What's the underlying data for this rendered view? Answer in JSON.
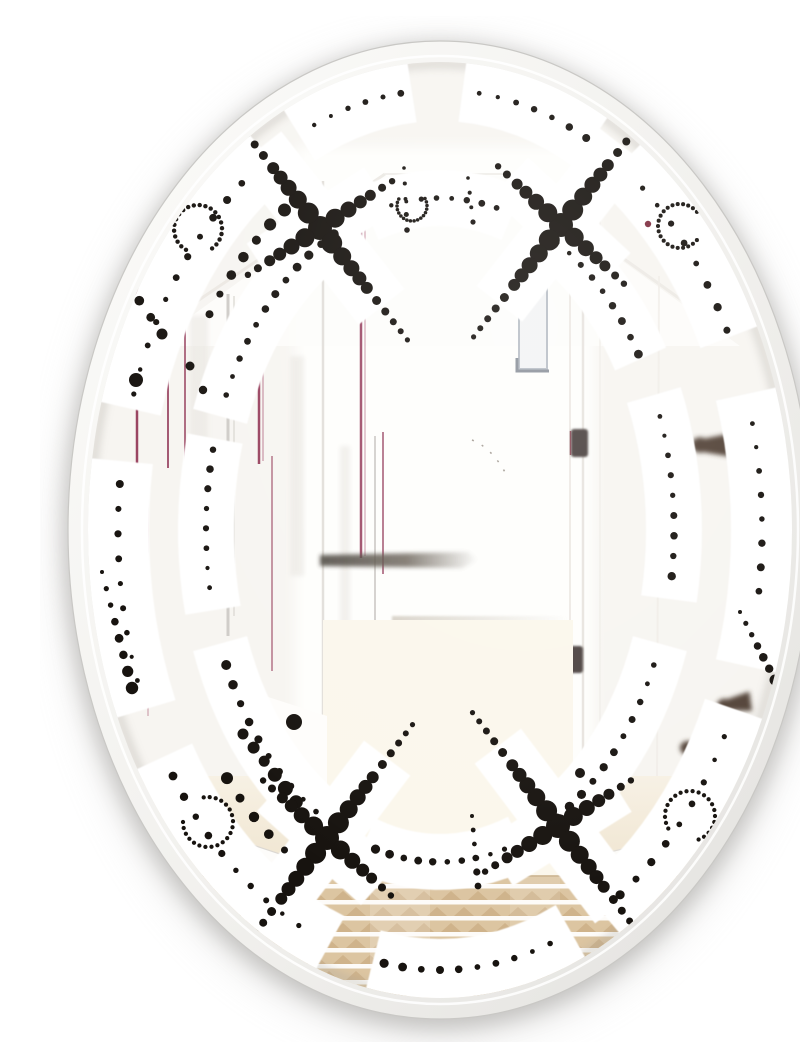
{
  "meta": {
    "subject": "Oval beveled wall mirror with a black dotted retro pattern printed on the glass, reflecting a bright white hallway with picture frames, an open white door and a beige striped rug"
  },
  "colors": {
    "background": "#ffffff",
    "shadow": "#a3a19e",
    "shadow_soft": "#b8b6b3",
    "bevel_light": "#fcfcfa",
    "bevel_dark": "#e2e1de",
    "bevel_edge": "#c9c8c5",
    "glass_base": "#f7f5f1",
    "glass_bright": "#fefefc",
    "band": "#ffffff",
    "dot": "#17130f",
    "maroon": "#8e2f50",
    "maroon_light": "#b0647e",
    "gray_line": "#cfccc8",
    "gray_line_light": "#dedbd6",
    "hinge": "#4b4240",
    "hinge_sliver": "#7e3040",
    "peg": "#453528",
    "bench_shadow": "#4f4840",
    "dim_line": "#d6cfc4",
    "window_frame": "#b9bfc7",
    "window_corner": "#8d939c",
    "wedge": "#6e6861",
    "floor": "#f6efe1",
    "floor_bright": "#fbf7ec",
    "rug_base": "#dcc5a1",
    "rug_stripe": "#ffffff",
    "rug_triangle": "#c9ab81",
    "rug_edge": "#c3a87f"
  },
  "mirror": {
    "cx": 400,
    "cy": 514,
    "rx": 372,
    "ry": 489,
    "glass_rx": 352,
    "glass_ry": 468
  },
  "pattern": {
    "rings": {
      "outer": {
        "rx": 322,
        "ry": 440,
        "band": 62
      },
      "inner": {
        "rx": 234,
        "ry": 332,
        "band": 56
      },
      "mid": {
        "rx": 278,
        "ry": 386,
        "band": 0
      }
    },
    "band_segments": {
      "outer": [
        [
          196,
          240
        ],
        [
          244,
          266
        ],
        [
          274,
          300
        ],
        [
          304,
          336
        ],
        [
          342,
          378
        ],
        [
          24,
          60
        ],
        [
          66,
          104
        ],
        [
          110,
          150
        ],
        [
          156,
          190
        ]
      ],
      "inner": [
        [
          200,
          246
        ],
        [
          252,
          288
        ],
        [
          296,
          330
        ],
        [
          336,
          374
        ],
        [
          20,
          64
        ],
        [
          70,
          110
        ],
        [
          118,
          160
        ],
        [
          166,
          196
        ]
      ]
    },
    "x_motifs": [
      {
        "cx": 280,
        "cy": 212,
        "angle": 52
      },
      {
        "cx": 521,
        "cy": 209,
        "angle": 128
      },
      {
        "cx": 287,
        "cy": 822,
        "angle": 127
      },
      {
        "cx": 518,
        "cy": 810,
        "angle": 53
      }
    ],
    "hooks": [
      {
        "cx": 158,
        "cy": 213,
        "r": 24,
        "a0": 120,
        "a1": 420,
        "dr": 2.6
      },
      {
        "cx": 372,
        "cy": 190,
        "r": 15,
        "a0": -30,
        "a1": 210,
        "dr": 2.1
      },
      {
        "cx": 640,
        "cy": 210,
        "r": 22,
        "a0": 40,
        "a1": 330,
        "dr": 2.4
      },
      {
        "cx": 168,
        "cy": 806,
        "r": 25,
        "a0": -100,
        "a1": 180,
        "dr": 2.5
      },
      {
        "cx": 650,
        "cy": 800,
        "r": 25,
        "a0": 150,
        "a1": 430,
        "dr": 2.5
      }
    ],
    "arc_chains": [
      {
        "ring": "outer",
        "a0": 198,
        "a1": 232,
        "n": 11,
        "r0": 2.6,
        "r1": 4.2
      },
      {
        "ring": "outer",
        "a0": 247,
        "a1": 263,
        "n": 6,
        "r0": 2.2,
        "r1": 3.4
      },
      {
        "ring": "outer",
        "a0": 277,
        "a1": 297,
        "n": 7,
        "r0": 2.4,
        "r1": 4.0
      },
      {
        "ring": "outer",
        "a0": 309,
        "a1": 333,
        "n": 8,
        "r0": 2.6,
        "r1": 4.4
      },
      {
        "ring": "outer",
        "a0": 346,
        "a1": 368,
        "n": 8,
        "r0": 2.4,
        "r1": 4.2
      },
      {
        "ring": "outer",
        "a0": 28,
        "a1": 56,
        "n": 9,
        "r0": 2.6,
        "r1": 4.6
      },
      {
        "ring": "outer",
        "a0": 70,
        "a1": 100,
        "n": 10,
        "r0": 2.8,
        "r1": 4.6
      },
      {
        "ring": "outer",
        "a0": 116,
        "a1": 146,
        "n": 10,
        "r0": 2.6,
        "r1": 4.4
      },
      {
        "ring": "outer",
        "a0": 160,
        "a1": 186,
        "n": 9,
        "r0": 2.4,
        "r1": 4.0
      },
      {
        "ring": "inner",
        "a0": 204,
        "a1": 243,
        "n": 12,
        "r0": 2.8,
        "r1": 5.0
      },
      {
        "ring": "inner",
        "a0": 258,
        "a1": 284,
        "n": 8,
        "r0": 2.2,
        "r1": 3.6
      },
      {
        "ring": "inner",
        "a0": 300,
        "a1": 328,
        "n": 9,
        "r0": 2.6,
        "r1": 4.4
      },
      {
        "ring": "inner",
        "a0": 340,
        "a1": 368,
        "n": 9,
        "r0": 2.4,
        "r1": 4.2
      },
      {
        "ring": "inner",
        "a0": 24,
        "a1": 60,
        "n": 11,
        "r0": 2.8,
        "r1": 5.0
      },
      {
        "ring": "inner",
        "a0": 74,
        "a1": 106,
        "n": 10,
        "r0": 2.6,
        "r1": 4.6
      },
      {
        "ring": "inner",
        "a0": 122,
        "a1": 156,
        "n": 10,
        "r0": 2.8,
        "r1": 5.0
      },
      {
        "ring": "inner",
        "a0": 170,
        "a1": 194,
        "n": 8,
        "r0": 2.4,
        "r1": 4.0
      },
      {
        "ring": "mid",
        "a0": 214,
        "a1": 236,
        "n": 7,
        "r0": 4.0,
        "r1": 6.5
      },
      {
        "ring": "mid",
        "a0": 120,
        "a1": 140,
        "n": 6,
        "r0": 4.0,
        "r1": 6.0
      }
    ],
    "line_chains": [
      {
        "x0": 62,
        "y0": 556,
        "x1": 92,
        "y1": 672,
        "n": 8,
        "r0": 2.0,
        "r1": 6.2
      },
      {
        "x0": 700,
        "y0": 596,
        "x1": 735,
        "y1": 664,
        "n": 7,
        "r0": 2.0,
        "r1": 5.5
      },
      {
        "x0": 652,
        "y0": 156,
        "x1": 706,
        "y1": 232,
        "n": 7,
        "r0": 2.5,
        "r1": 6.0
      },
      {
        "x0": 52,
        "y0": 828,
        "x1": 92,
        "y1": 888,
        "n": 6,
        "r0": 3.0,
        "r1": 5.5
      },
      {
        "x0": 88,
        "y0": 268,
        "x1": 122,
        "y1": 318,
        "n": 4,
        "r0": 4.5,
        "r1": 5.5
      },
      {
        "x0": 364,
        "y0": 152,
        "x1": 367,
        "y1": 214,
        "n": 5,
        "r0": 1.8,
        "r1": 2.8
      },
      {
        "x0": 428,
        "y0": 162,
        "x1": 433,
        "y1": 206,
        "n": 4,
        "r0": 1.8,
        "r1": 2.6
      },
      {
        "x0": 432,
        "y0": 800,
        "x1": 438,
        "y1": 870,
        "n": 6,
        "r0": 2.0,
        "r1": 4.0
      },
      {
        "x0": 203,
        "y0": 718,
        "x1": 256,
        "y1": 786,
        "n": 6,
        "r0": 5.5,
        "r1": 8.0
      }
    ],
    "accent_dots": [
      {
        "x": 608,
        "y": 208,
        "r": 3.2,
        "c": "#7e2d3f"
      },
      {
        "x": 96,
        "y": 364,
        "r": 7,
        "c": ""
      },
      {
        "x": 254,
        "y": 706,
        "r": 8,
        "c": ""
      },
      {
        "x": 540,
        "y": 757,
        "r": 5,
        "c": ""
      },
      {
        "x": 150,
        "y": 350,
        "r": 4.5,
        "c": ""
      },
      {
        "x": 163,
        "y": 374,
        "r": 4.2,
        "c": ""
      }
    ]
  },
  "reflection": {
    "scene_lines": [
      [
        150,
        290,
        345,
        158,
        3,
        "#eae7e2",
        0.9
      ],
      [
        650,
        290,
        465,
        158,
        3,
        "#ece9e4",
        0.9
      ],
      [
        345,
        158,
        465,
        158,
        2,
        "#edebe6",
        0.8
      ],
      [
        283,
        165,
        283,
        806,
        2.5,
        "#e2dfda",
        1
      ],
      [
        530,
        160,
        530,
        806,
        2,
        "#eeeae5",
        1
      ],
      [
        543,
        150,
        543,
        870,
        2.5,
        "#e8e4df",
        1
      ],
      [
        560,
        200,
        560,
        840,
        1.5,
        "#efece7",
        0.8
      ],
      [
        619,
        260,
        617,
        760,
        2,
        "#f0ede8",
        0.8
      ],
      [
        60,
        792,
        740,
        795,
        1.5,
        "#eadfc9",
        0.5
      ],
      [
        70,
        828,
        730,
        830,
        1.5,
        "#eadfc9",
        0.45
      ]
    ],
    "frame_lines": [
      [
        97,
        256,
        97,
        448,
        2.5,
        "maroon",
        0.9
      ],
      [
        101,
        452,
        101,
        560,
        2,
        "maroon_light",
        0.55
      ],
      [
        128,
        300,
        128,
        452,
        2,
        "maroon",
        0.8
      ],
      [
        145,
        298,
        145,
        560,
        2,
        "maroon",
        0.7
      ],
      [
        188,
        278,
        188,
        620,
        3,
        "gray_line",
        1
      ],
      [
        194,
        280,
        194,
        600,
        1.5,
        "gray_line_light",
        1
      ],
      [
        219,
        270,
        219,
        448,
        2.5,
        "maroon",
        0.9
      ],
      [
        223,
        272,
        223,
        445,
        1.2,
        "maroon_light",
        0.7
      ],
      [
        232,
        440,
        232,
        655,
        2,
        "maroon",
        0.5
      ],
      [
        321,
        176,
        321,
        542,
        2.5,
        "maroon",
        0.85
      ],
      [
        325,
        178,
        325,
        540,
        1.2,
        "maroon_light",
        0.6
      ],
      [
        335,
        420,
        335,
        628,
        2,
        "gray_line",
        0.9
      ],
      [
        343,
        416,
        343,
        558,
        2,
        "maroon",
        0.65
      ],
      [
        108,
        470,
        108,
        700,
        1.5,
        "maroon_light",
        0.45
      ],
      [
        75,
        520,
        75,
        700,
        1.5,
        "gray_line_light",
        0.6
      ]
    ],
    "frame_shadows": [
      [
        150,
        300,
        18,
        160
      ],
      [
        250,
        340,
        14,
        220
      ],
      [
        300,
        430,
        10,
        180
      ]
    ],
    "center_room": {
      "bench": {
        "x0": 280,
        "y0": 536,
        "x1": 438,
        "y1": 552
      },
      "floor_line": {
        "x0": 352,
        "y0": 600,
        "x1": 528,
        "y1": 606
      },
      "arc": "M432,424 Q452,432 466,458",
      "window": {
        "x": 479,
        "y": 240,
        "w": 28,
        "h": 113
      },
      "wedge": "M537,183 L554,186 L554,212 L544,204 Z"
    },
    "hinges": [
      {
        "x": 531,
        "y": 413,
        "w": 17,
        "h": 28
      },
      {
        "x": 527,
        "y": 630,
        "w": 16,
        "h": 27
      }
    ],
    "pegs": [
      {
        "x": 660,
        "y": 429,
        "s": 1.1,
        "a": 0
      },
      {
        "x": 618,
        "y": 508,
        "s": 0.75,
        "a": 10
      },
      {
        "x": 684,
        "y": 689,
        "s": 0.9,
        "a": -8
      },
      {
        "x": 648,
        "y": 732,
        "s": 1.0,
        "a": 5
      },
      {
        "x": 693,
        "y": 797,
        "s": 0.9,
        "a": 0
      }
    ],
    "panels": [
      {
        "d": "M30,768 L282,852 L282,876 L30,794 Z",
        "f": "#fdfcfa",
        "s": "#dcd8d2"
      },
      {
        "d": "M545,842 L770,788 L770,810 L545,866 Z",
        "f": "#fcfbf8",
        "s": "#e0dcd6"
      },
      {
        "d": "M225,680 L287,700 L287,782 L225,746 Z",
        "f": "#fefdfb",
        "s": "none"
      }
    ],
    "rug": {
      "x": 40,
      "y": 860,
      "w": 720,
      "h": 152,
      "stripe_step": 16,
      "stripe_h": 4.5,
      "tri_w": 20,
      "tri_h": 9,
      "tri_step": 27
    }
  }
}
